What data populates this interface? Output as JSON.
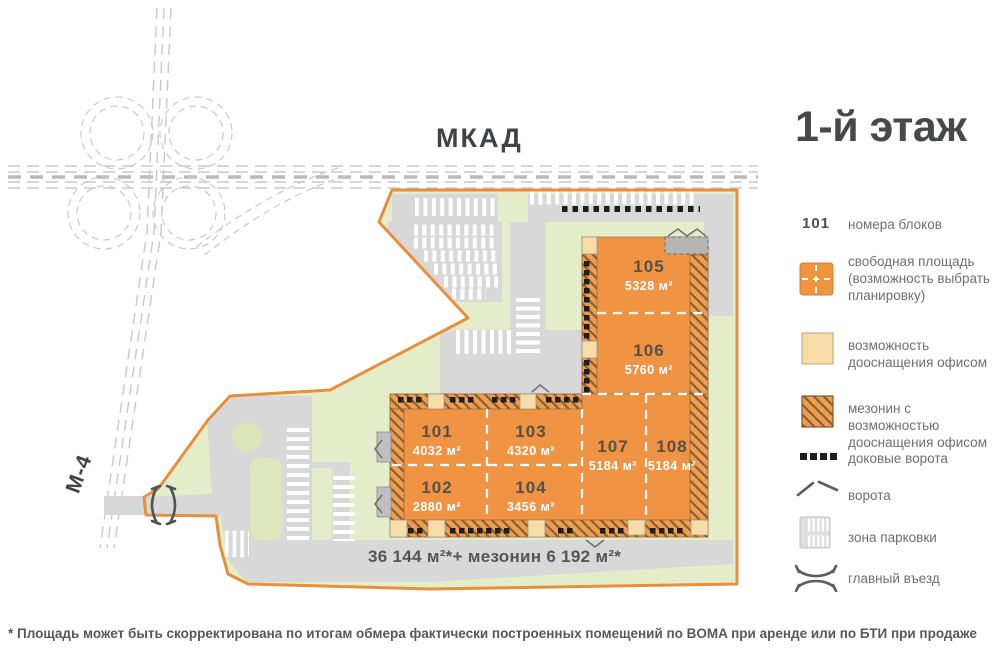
{
  "title": "1-й этаж",
  "map": {
    "mkad_label": "МКАД",
    "m4_label": "М-4",
    "total_area": "36 144 м²*+ мезонин 6 192 м²*",
    "blocks": [
      {
        "number": "101",
        "area": "4032 м²"
      },
      {
        "number": "102",
        "area": "2880 м²"
      },
      {
        "number": "103",
        "area": "4320 м²"
      },
      {
        "number": "104",
        "area": "3456 м²"
      },
      {
        "number": "105",
        "area": "5328 м²"
      },
      {
        "number": "106",
        "area": "5760 м²"
      },
      {
        "number": "107",
        "area": "5184 м²"
      },
      {
        "number": "108",
        "area": "5184 м²"
      }
    ]
  },
  "legend": {
    "items": [
      {
        "badge": "101",
        "label": "номера блоков"
      },
      {
        "label": "свободная площадь (возможность выбрать планировку)"
      },
      {
        "label": "возможность дооснащения офисом"
      },
      {
        "label": "мезонин с возможностью дооснащения офисом"
      },
      {
        "label": "доковые ворота"
      },
      {
        "label": "ворота"
      },
      {
        "label": "зона парковки"
      },
      {
        "label": "главный въезд"
      }
    ]
  },
  "footnote": "* Площадь может быть скорректирована по итогам обмера фактически построенных помещений по BOMA при аренде или по БТИ при продаже",
  "colors": {
    "block_fill": "#F09443",
    "boundary": "#E88F3C",
    "office_beige": "#F7DCA7",
    "landscape_green": "#E4EDCA",
    "road_gray": "#D8D8D8",
    "text_dark": "#47484b"
  }
}
